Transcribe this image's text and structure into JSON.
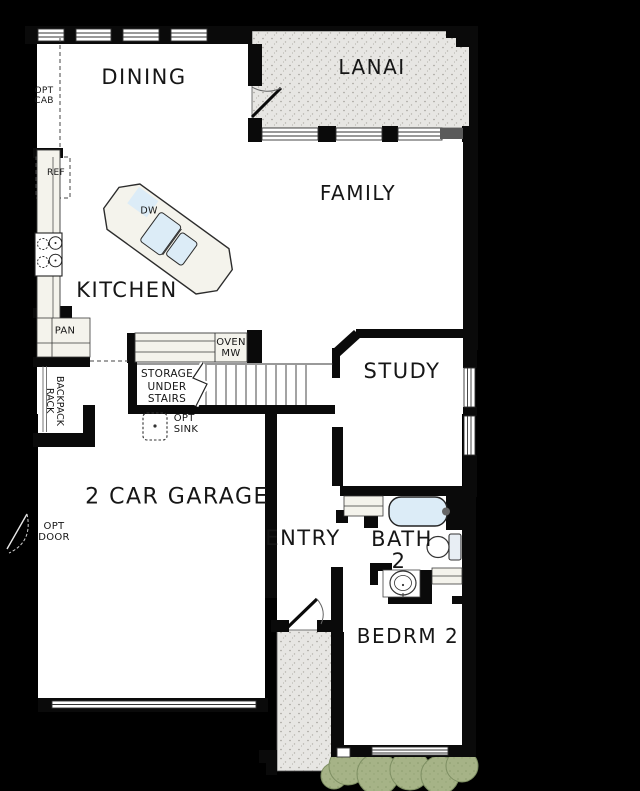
{
  "plan_title": "First floor plan",
  "rooms": {
    "dining": "DINING",
    "lanai": "LANAI",
    "family": "FAMILY",
    "kitchen": "KITCHEN",
    "study": "STUDY",
    "garage": "2 CAR GARAGE",
    "entry": "ENTRY",
    "bath_line1": "BATH",
    "bath_line2": "2",
    "bedroom2": "BEDRM 2"
  },
  "annotations": {
    "opt_cab_line1": "OPT",
    "opt_cab_line2": "CAB",
    "ref": "REF",
    "dw": "DW",
    "pan": "PAN",
    "backpack_line1": "BACKPACK",
    "backpack_line2": "RACK",
    "storage_line1": "STORAGE",
    "storage_line2": "UNDER",
    "storage_line3": "STAIRS",
    "oven_line1": "OVEN",
    "oven_line2": "MW",
    "opt_sink_line1": "OPT",
    "opt_sink_line2": "SINK",
    "opt_door_line1": "OPT",
    "opt_door_line2": "DOOR"
  },
  "colors": {
    "background": "#000000",
    "floor": "#ffffff",
    "wall": "#0a0a0a",
    "texture_fill": "#e7e6e3",
    "texture_dot": "#a29f99",
    "counter_fill": "#f4f3ec",
    "fixture_blue": "#dcecf7",
    "shrub_green": "#a6b387",
    "text": "#161616"
  }
}
